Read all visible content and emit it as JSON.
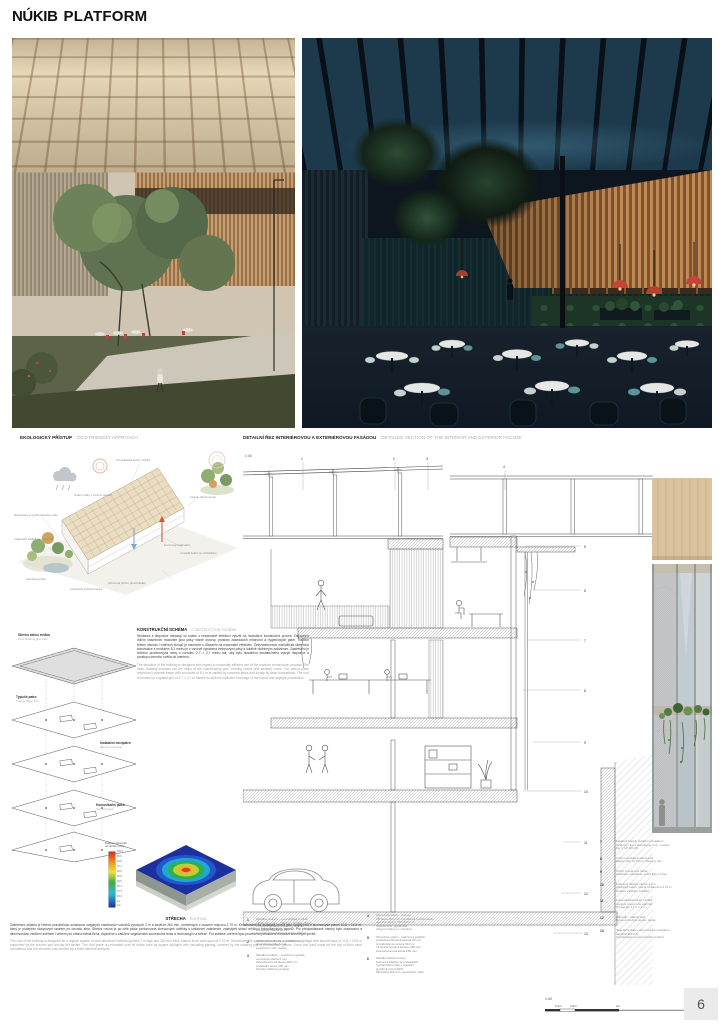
{
  "logo": {
    "text_left": "NÚKIB",
    "text_right": "PLATFORM"
  },
  "page": {
    "number": "6"
  },
  "headers": {
    "eco": {
      "title": "EKOLOGICKÝ PŘÍSTUP",
      "subtitle": "ECO-FRIENDLY APPROACH"
    },
    "detail": {
      "title": "DETAILNÍ ŘEZ INTERIÉROVOU A EXTERIÉROVOU FASÁDOU",
      "subtitle": "DETAILED SECTION OF THE INTERIOR AND EXTERIOR FACADE",
      "scale": "1:40"
    }
  },
  "construction": {
    "title": "KONSTRUKČNÍ SCHÉMA",
    "subtitle": "CONSTRUCTION SCHEME",
    "paragraph_cz": "Struktura a dispozice navazují ve snaze o maximálně efektivní využití na modulární konstrukční proces. Základním dílčím stavebním modulem jsou pásy nosné osnovy, prostory zasedacích místností a hygienických jader. Tradiční řešení obvodu i vnitřních sloupů je navrženo s důrazem na maximální efektivitu. Železobetonová monolitická skeletová konstrukce s modulem 8,1 metru je v osnově vynášena betonovými pásy a lokálně hlubinným založením. Zastřešení je tvořeno prostorovými rámy o rozměru 2,7 × 2,7 metru tak, aby bylo dosaženo dostatečného vykrytí dispozice a prostupu denního světla do interiéru.",
    "paragraph_en": "The structure of the building is designed with regard to maximally efficient use of the modular construction process. The basic building modules are the strips of the load-bearing grid, meeting rooms and sanitary cores. The cast-in-place reinforced concrete frame with a module of 8.1 m is carried by concrete strips and locally by deep foundations. The roof is formed by a spatial grid of 2.7 × 2.7 m frames to achieve sufficient coverage of the layout and daylight penetration."
  },
  "roof": {
    "title": "STŘECHA",
    "subtitle": "ROOFING",
    "paragraph_cz": "Zastřešení objektu je řešeno pravidelnou soustavou napjatých kazetových vazníků vysokých 2 m a tloušťce 260 mm, umístěných v osovém rozponu 2,70 m. Konstrukčně se soustava chová jako spojitý rošt o čtvercových polích 10,8 × 10,8 m, který je podepřen sloupovým rastrem po obvodu atria. Střešní rovina je po celé ploše perforována čtvercovými světlíky s izolačním zasklením, zakrytými stínicí mřížkou fotovoltaických panelů. Pro předpokládané návrhy bylo zvažováno a dimenzováno zatížení sněhem i větrem pro oblast města Brna, doplněné o zatížení vegetačními souvrstvími teras a technologií na střeše. Pro statické ověření bylo provedeno posouzení metodou konečných prvků.",
    "paragraph_en": "The roof of the building is designed as a regular system of post-tensioned coffered girders 2 m high and 260 mm thick, placed at an axial span of 2.70 m. Structurally the system behaves as a continuous grillage with square bays of 10.8 × 10.8 m supported by the column grid around the atrium. The roof plane is perforated over its whole area by square skylights with insulating glazing, covered by the shading grid of photovoltaic panels. Snow and wind loads for the city of Brno were considered and the structure was verified by a finite element analysis."
  },
  "eco_diagram": {
    "labels": [
      "fotovoltaická stínicí mřížka",
      "solární zisky v zimním období",
      "akumulace a využití dešťové vody",
      "vsakování srážek na pozemku",
      "retenční jezírko",
      "vzrostlá zeleň ve vnitrobloku",
      "přirozené příčné provětrávání",
      "komínový efekt atria",
      "zelené střechy teras",
      "extenzivní kvetoucí louky"
    ]
  },
  "axon": {
    "layers": [
      {
        "cz": "Střešní stínicí mřížka",
        "en": "Roof shading grid shell"
      },
      {
        "cz": "Typické patro",
        "en": "Typical office floor"
      },
      {
        "cz": "Instalační mezipatro",
        "en": "Service interlayer"
      },
      {
        "cz": "Komunikační jádra",
        "en": "Vertical cores"
      }
    ]
  },
  "heatmap": {
    "title_line1": "Diagram deformací",
    "title_line2": "od zatížení [mm]",
    "ticks": [
      "100.0",
      "90.9",
      "81.8",
      "72.7",
      "63.6",
      "54.5",
      "45.5",
      "36.4",
      "27.3",
      "18.2",
      "9.1",
      "0.0"
    ]
  },
  "section_drawing": {
    "scale": "1:40",
    "callouts": [
      "1",
      "2",
      "3",
      "4",
      "5",
      "6",
      "7",
      "8",
      "9",
      "10",
      "11",
      "12",
      "13"
    ]
  },
  "legend": {
    "col1": [
      {
        "num": "1",
        "lines": [
          "Skladba podlahy – kancelářské podlaží",
          "nášlapná vrstva – zátěžový koberec 8 mm",
          "zdvojená podlaha s dutinou 150 mm",
          "kročejová izolace 40 mm",
          "železobetonová stropní deska 260 mm"
        ]
      },
      {
        "num": "2",
        "lines": [
          "Podhledová lamela dub 40/60 mm",
          "akustická textilie černá",
          "systémový rošt, závěsy"
        ]
      },
      {
        "num": "3",
        "lines": [
          "Skladba podlahy – podzemní garáže",
          "epoxidová stěrka 5 mm",
          "železobetonová deska 300 mm",
          "podkladní beton 100 mm",
          "hutněný štěrkový podsyp"
        ]
      }
    ],
    "col2": [
      {
        "num": "4",
        "lines": [
          "Obvodová stěna – suterén",
          "ŽB stěna 300 mm, krystalická hydroizolace",
          "tepelná izolace XPS 120 mm",
          "nopová fólie, geotextilie",
          "zásyp hutněný po vrstvách"
        ]
      },
      {
        "num": "5",
        "lines": [
          "Obvodová stěna – nadzemní podlaží",
          "pohledová dřevěná lamela 40 mm",
          "provětrávaná mezera 60 mm",
          "minerální tepelná izolace 200 mm",
          "železobetonová stěna 250 mm"
        ]
      },
      {
        "num": "6",
        "lines": [
          "Skladba střešní terasy",
          "betonová dlažba na podložkách",
          "hydroizolační fólie s atestem",
          "spádová vrstva EPS",
          "ŽB deska 260 mm, penetrační nátěr"
        ]
      }
    ],
    "col3": [
      {
        "num": "7",
        "lines": [
          "Zasklení fasády izolačním trojsklem",
          "hliníkový rám s přerušeným tep. mostem",
          "Uw = 0,8 W/m²K"
        ]
      },
      {
        "num": "8",
        "lines": [
          "Vnitřní prosklená stěna atria",
          "kalené sklo 2× 8 mm, dřevěný rám"
        ]
      },
      {
        "num": "9",
        "lines": [
          "Stínicí screenová roleta",
          "elektricky ovládaná, vodicí lišty v rámu"
        ]
      },
      {
        "num": "10",
        "lines": [
          "Kazetový střešní vazník 2,0 m",
          "předpjatý beton, osová vzdálenost 2,70 m",
          "izolační zasklení světlíků"
        ]
      },
      {
        "num": "11",
        "lines": [
          "Fotovoltaická stínicí mřížka",
          "ocelové kotvení do vazníků",
          "PV panely 1,1 × 1,1 m"
        ]
      },
      {
        "num": "12",
        "lines": [
          "Zábradlí – kalené sklo",
          "kotvené do čela stropní desky"
        ]
      },
      {
        "num": "13",
        "lines": [
          "Vegetační žlab s automatickou závlahou",
          "substrát 400 mm",
          "hydroizolace proti prorůstání kořenů"
        ]
      }
    ]
  },
  "scalebar": {
    "scale": "1:40",
    "ticks": [
      "0.4m",
      "0.8m",
      "2m",
      "4m"
    ]
  },
  "colors": {
    "accent_red": "#c0443a",
    "wood": "#c79e6f",
    "dark_interior": "#0d151e"
  }
}
